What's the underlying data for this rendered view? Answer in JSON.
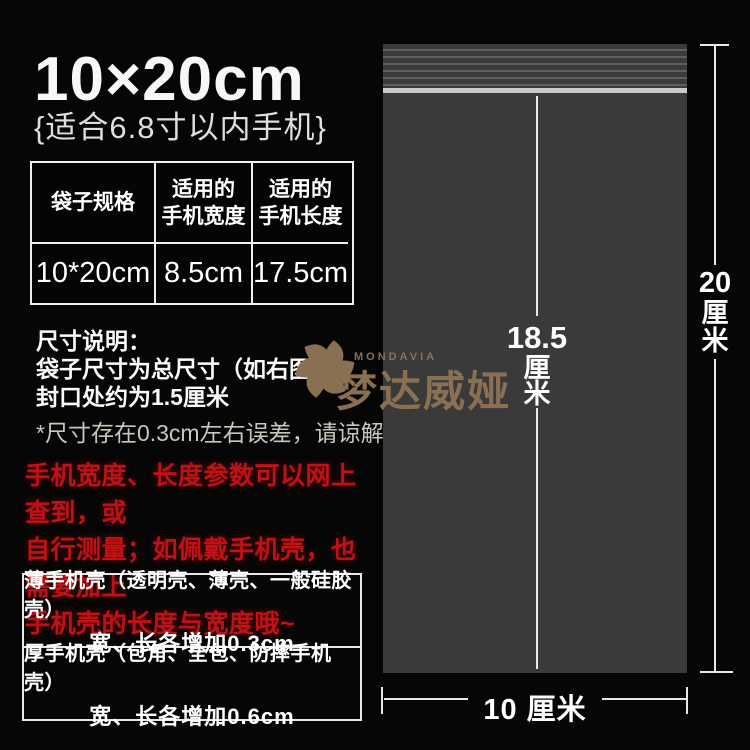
{
  "header": {
    "title": "10×20cm",
    "subtitle": "{适合6.8寸以内手机}"
  },
  "spec_table": {
    "headers": [
      {
        "lines": [
          "袋子规格"
        ]
      },
      {
        "lines": [
          "适用的",
          "手机宽度"
        ]
      },
      {
        "lines": [
          "适用的",
          "手机长度"
        ]
      }
    ],
    "row": [
      "10*20cm",
      "8.5cm",
      "17.5cm"
    ]
  },
  "size_notes": {
    "heading": "尺寸说明：",
    "line1": "袋子尺寸为总尺寸（如右图）",
    "line2": "封口处约为1.5厘米",
    "disclaimer": "*尺寸存在0.3cm左右误差，请谅解"
  },
  "tips": {
    "line1": "手机宽度、长度参数可以网上查到，或",
    "line2": "自行测量；如佩戴手机壳，也需要加上",
    "line3": "手机壳的长度与宽度哦~"
  },
  "case_boxes": [
    {
      "title": "薄手机壳（透明壳、薄壳、一般硅胶壳）",
      "value": "宽、长各增加0.3cm"
    },
    {
      "title": "厚手机壳（包角、全包、防摔手机壳）",
      "value": "宽、长各增加0.6cm"
    }
  ],
  "diagram": {
    "inner_height": {
      "value": "18.5",
      "unit_chars": [
        "厘",
        "米"
      ]
    },
    "outer_height": {
      "value": "20",
      "unit_chars": [
        "厘",
        "米"
      ]
    },
    "width_label": "10 厘米"
  },
  "watermark": {
    "brand_en": "MONDAVIA",
    "brand_cn": "梦达威娅"
  },
  "colors": {
    "background": "#060606",
    "bag_body": "#3a3a3a",
    "zip_bar": "#c9c9c9",
    "tip_red": "#c01117",
    "watermark_tan": "#8a7053",
    "text_white": "#f7f7f7"
  }
}
